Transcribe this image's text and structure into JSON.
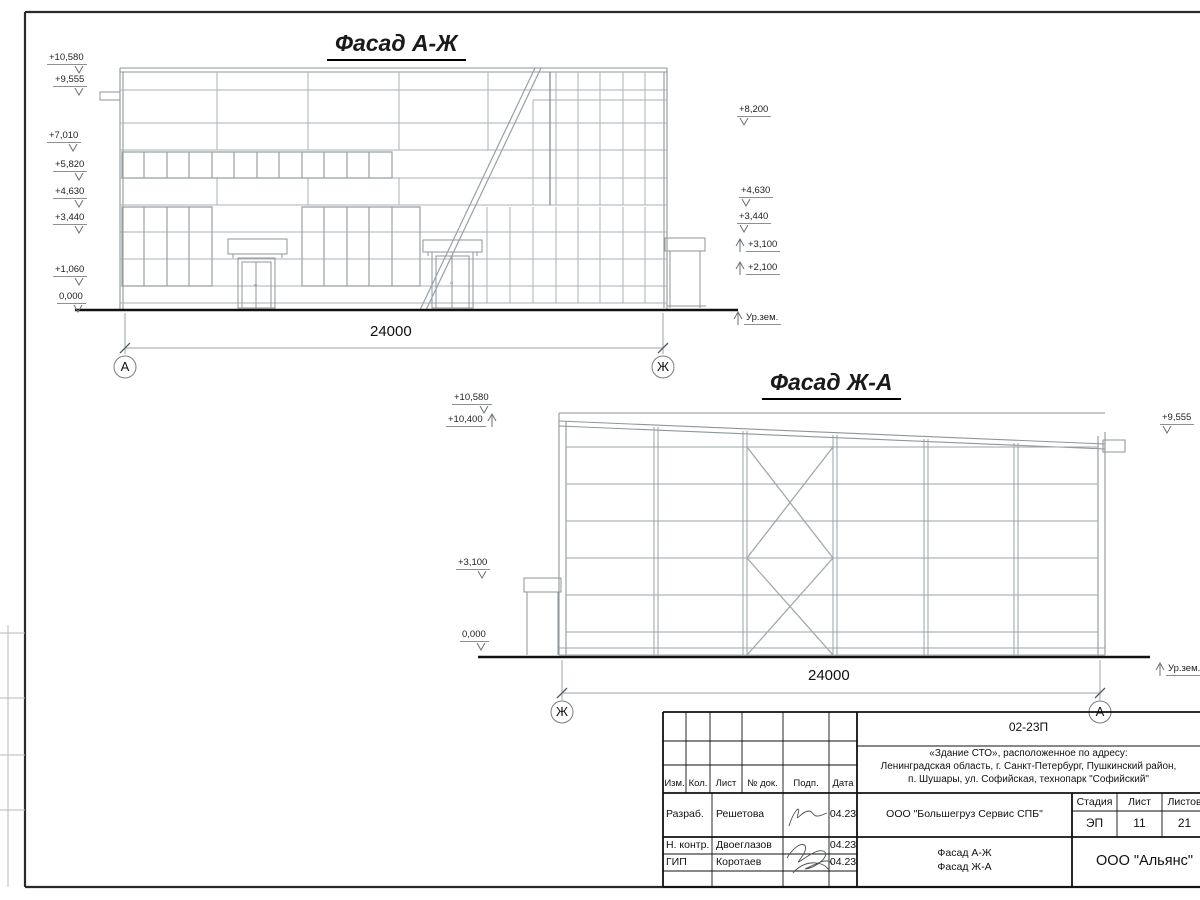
{
  "facade1": {
    "title": "Фасад А-Ж",
    "marks_left": [
      "+10,580",
      "+9,555",
      "+7,010",
      "+5,820",
      "+4,630",
      "+3,440",
      "+1,060",
      "0,000"
    ],
    "marks_right": [
      "+8,200",
      "+4,630",
      "+3,440",
      "+3,100",
      "+2,100"
    ],
    "ground_label": "Ур.зем.",
    "dimension": "24000",
    "axis_left": "А",
    "axis_right": "Ж"
  },
  "facade2": {
    "title": "Фасад Ж-А",
    "marks_left": [
      "+10,580",
      "+10,400",
      "+3,100",
      "0,000"
    ],
    "marks_right": [
      "+9,555"
    ],
    "ground_label": "Ур.зем.",
    "dimension": "24000",
    "axis_left": "Ж",
    "axis_right": "А"
  },
  "titleblock": {
    "doc_number": "02-23П",
    "project_line1": "«Здание СТО», расположенное по адресу:",
    "project_line2": "Ленинградская область, г. Санкт-Петербург, Пушкинский район,",
    "project_line3": "п. Шушары, ул. Софийская, технопарк \"Софийский\"",
    "col_izm": "Изм.",
    "col_kol": "Кол.",
    "col_list": "Лист",
    "col_ndok": "№ док.",
    "col_podp": "Подп.",
    "col_data": "Дата",
    "row1_role": "Разраб.",
    "row1_name": "Решетова",
    "row1_date": "04.23",
    "row2_role": "Н. контр.",
    "row2_name": "Двоеглазов",
    "row2_date": "04.23",
    "row3_role": "ГИП",
    "row3_name": "Коротаев",
    "row3_date": "04.23",
    "client": "ООО \"Большегруз Сервис СПБ\"",
    "stage_label": "Стадия",
    "sheet_label": "Лист",
    "sheets_label": "Листов",
    "stage": "ЭП",
    "sheet": "11",
    "sheets": "21",
    "drawing_name1": "Фасад А-Ж",
    "drawing_name2": "Фасад Ж-А",
    "company": "ООО \"Альянс\""
  }
}
